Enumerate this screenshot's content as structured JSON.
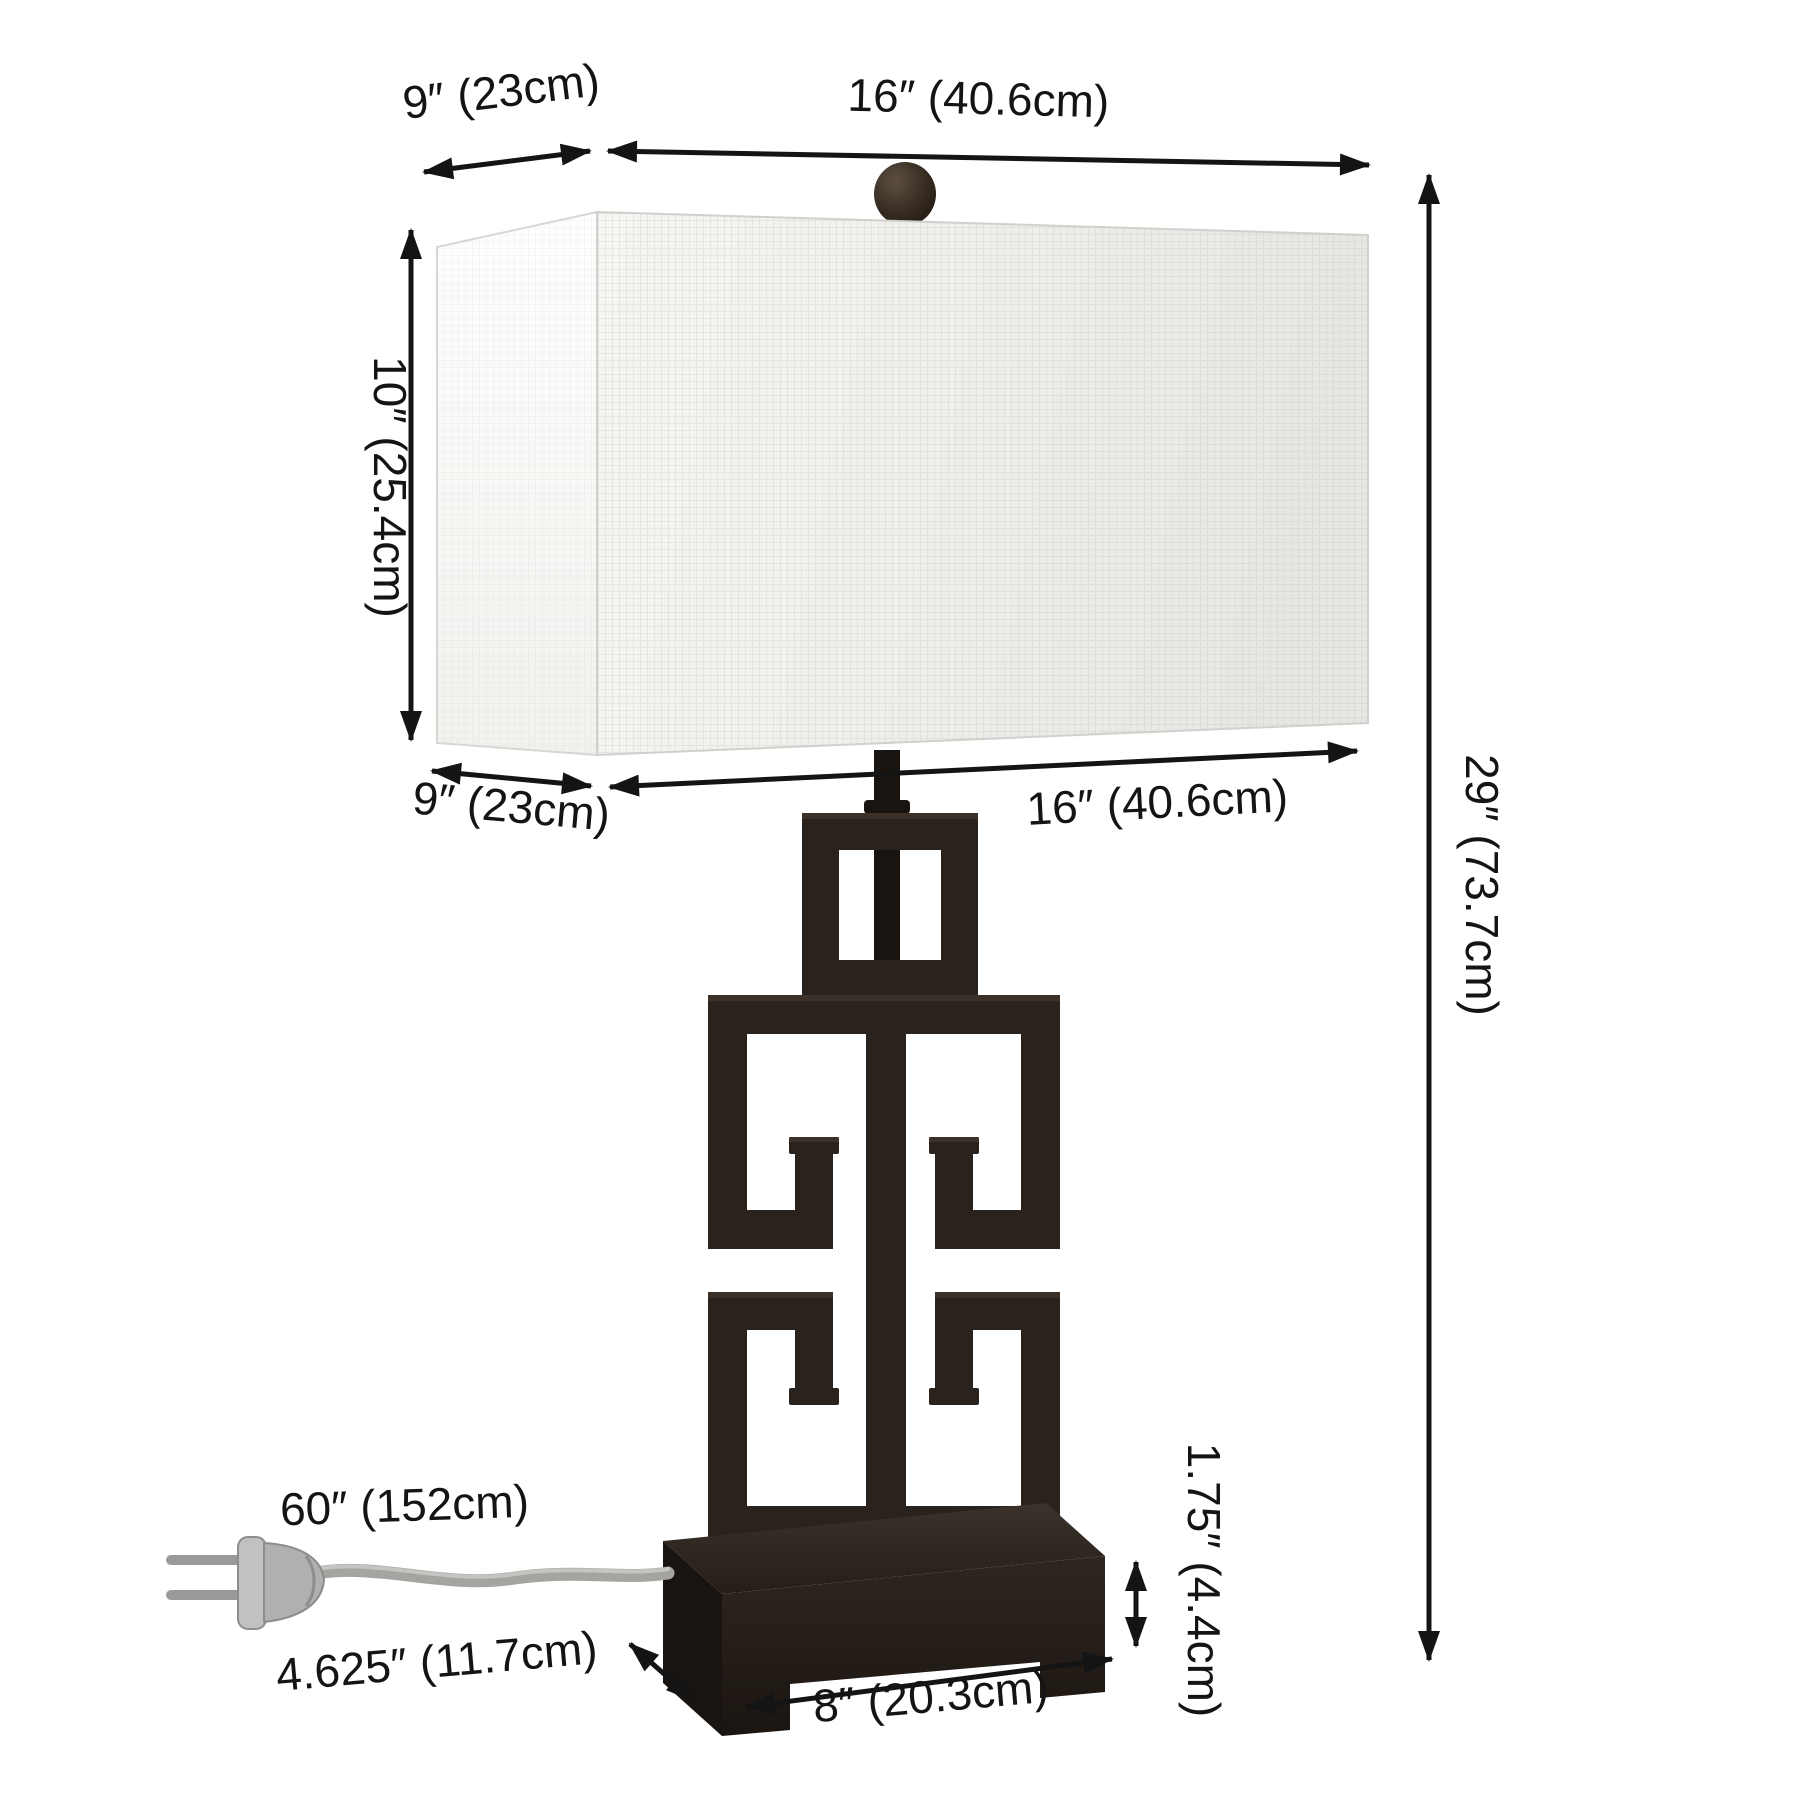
{
  "diagram_title": "table-lamp-dimension-diagram",
  "dims": {
    "top_depth": {
      "label": "9″ (23cm)"
    },
    "top_width": {
      "label": "16″ (40.6cm)"
    },
    "shade_height": {
      "label": "10″ (25.4cm)"
    },
    "bottom_depth": {
      "label": "9″ (23cm)"
    },
    "bottom_width": {
      "label": "16″ (40.6cm)"
    },
    "overall_height": {
      "label": "29″ (73.7cm)"
    },
    "cord_length": {
      "label": "60″ (152cm)"
    },
    "base_depth": {
      "label": "4.625″ (11.7cm)"
    },
    "base_width": {
      "label": "8″ (20.3cm)"
    },
    "base_height": {
      "label": "1.75″ (4.4cm)"
    }
  },
  "colors": {
    "ink": "#141414",
    "metal": "#2a221c",
    "metal-dark": "#1a1410",
    "metal-light": "#4a3e33",
    "shade-front-1": "#f7f6f3",
    "shade-front-2": "#e7e6e2",
    "shade-side-1": "#fefefe",
    "shade-side-2": "#f2f1ee",
    "cord": "#a6a4a1",
    "plug": "#b2b0ae"
  }
}
